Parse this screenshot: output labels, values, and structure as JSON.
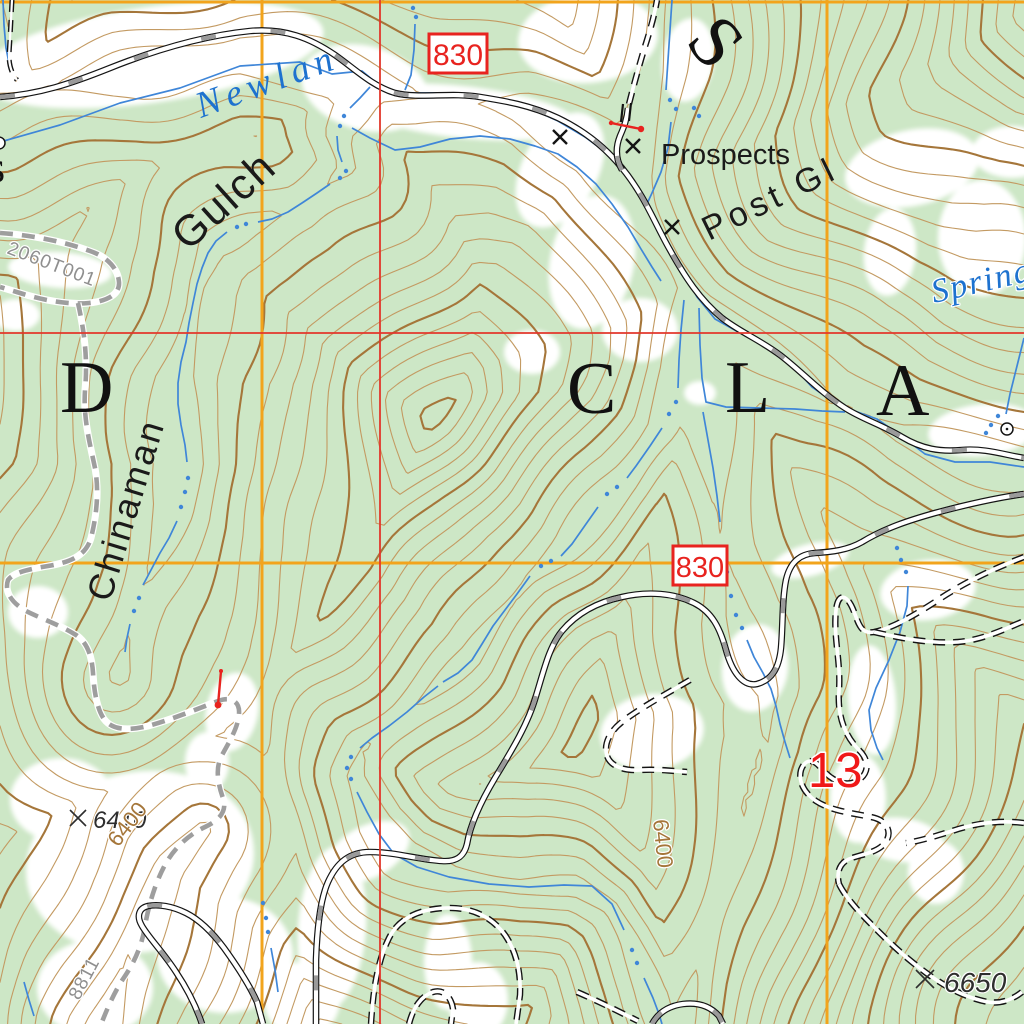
{
  "map": {
    "water_labels": {
      "newlan": "Newlan",
      "spring": "Spring"
    },
    "feature_labels": {
      "gulch": "Gulch",
      "chinaman": "Chinaman",
      "prospects": "Prospects",
      "post_gl": "Post Gl",
      "big_s": "S",
      "partial_s": "s"
    },
    "boundary_letters": [
      "D",
      "C",
      "L",
      "A"
    ],
    "route_shields": [
      "830",
      "830"
    ],
    "section_number": "13",
    "spot_elevations": [
      {
        "value": "6410"
      },
      {
        "value": "6650"
      }
    ],
    "contour_labels": [
      "6400",
      "6400"
    ],
    "road_numbers": [
      "2060T001",
      "8811"
    ],
    "colors": {
      "forest_green": "#cde7c6",
      "clearing_white": "#ffffff",
      "contour_brown": "#c39a62",
      "contour_index_brown": "#a5763a",
      "water_blue": "#3f86d8",
      "water_label_blue": "#1e72cf",
      "grid_orange": "#f2a41c",
      "grid_red": "#e2372b",
      "marker_red": "#e8231f",
      "road_dash_gray": "#9a9a9a",
      "unimproved_gray": "#9e9e9e",
      "label_black": "#1a1a1a",
      "road_number_gray": "#8f8f8f",
      "spot_gray": "#2e2e2e"
    }
  }
}
